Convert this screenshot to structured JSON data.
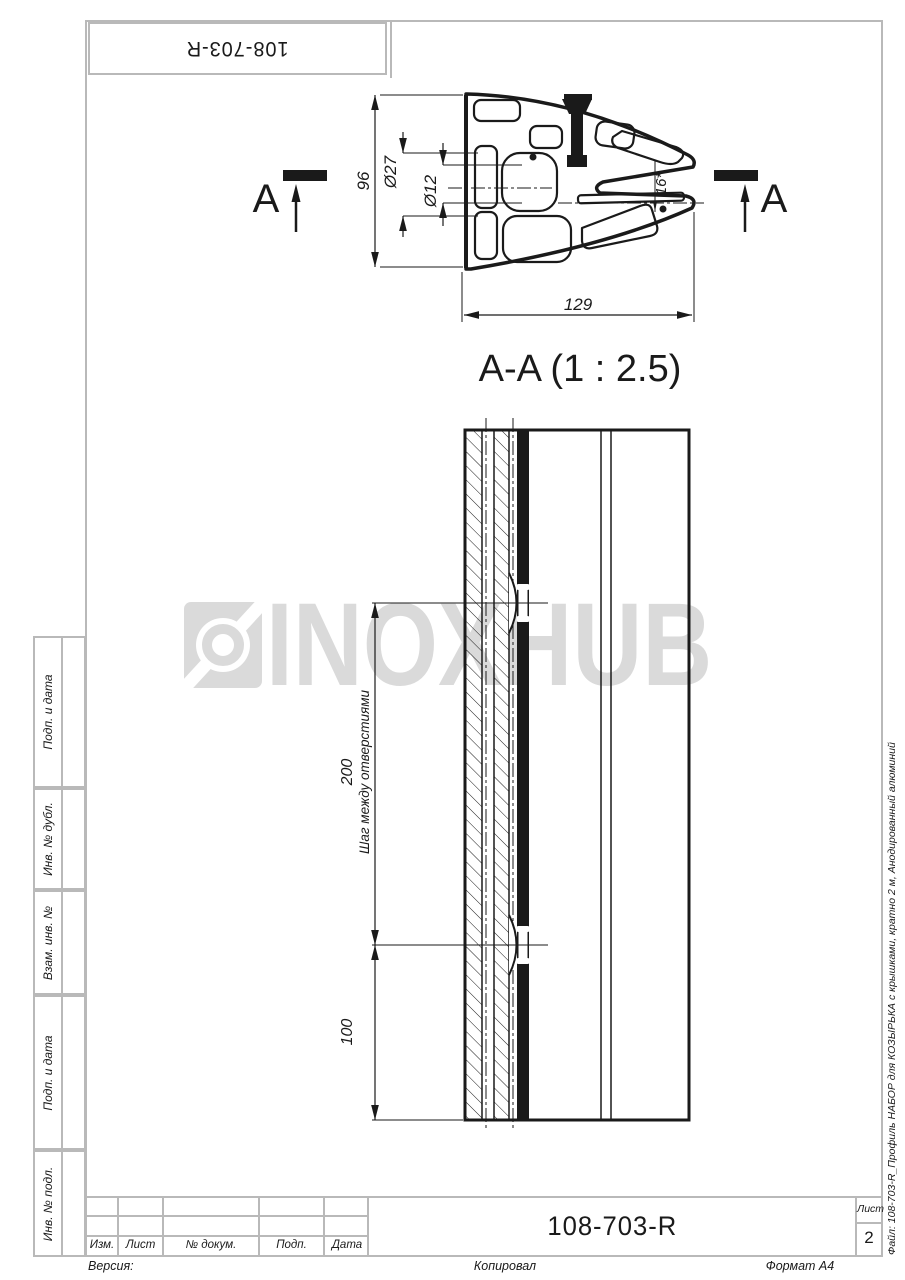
{
  "top_stamp": {
    "designation": "108-703-R"
  },
  "watermark": {
    "text": "INOXHUB"
  },
  "profile_view": {
    "section_letter_left": "A",
    "section_letter_right": "A",
    "dim_height": "96",
    "dim_outer_dia": "Ø27",
    "dim_inner_dia": "Ø12",
    "dim_angle": "16*",
    "dim_width": "129"
  },
  "section_view": {
    "title": "A-A (1 : 2.5)",
    "dim_step": "200",
    "dim_step_note": "Шаг между отверстиями",
    "dim_end": "100"
  },
  "side_stamp": {
    "labels": [
      "Подп. и дата",
      "Инв. № дубл.",
      "Взам. инв. №",
      "Подп. и дата",
      "Инв. № подл."
    ]
  },
  "title_block": {
    "col_izm": "Изм.",
    "col_list": "Лист",
    "col_doc": "№ докум.",
    "col_podp": "Подп.",
    "col_data": "Дата",
    "designation": "108-703-R",
    "sheet_label": "Лист",
    "sheet_number": "2"
  },
  "margins": {
    "version": "Версия:",
    "copied": "Копировал",
    "format": "Формат A4",
    "file_note": "Файл: 108-703-R_Профиль НАБОР для КОЗЫРЬКА с крышками, кратно 2 м, Анодированный алюминий"
  },
  "colors": {
    "frame_gray": "#b9b9b9",
    "ink": "#1a1a1a",
    "watermark_gray": "#dadada"
  }
}
